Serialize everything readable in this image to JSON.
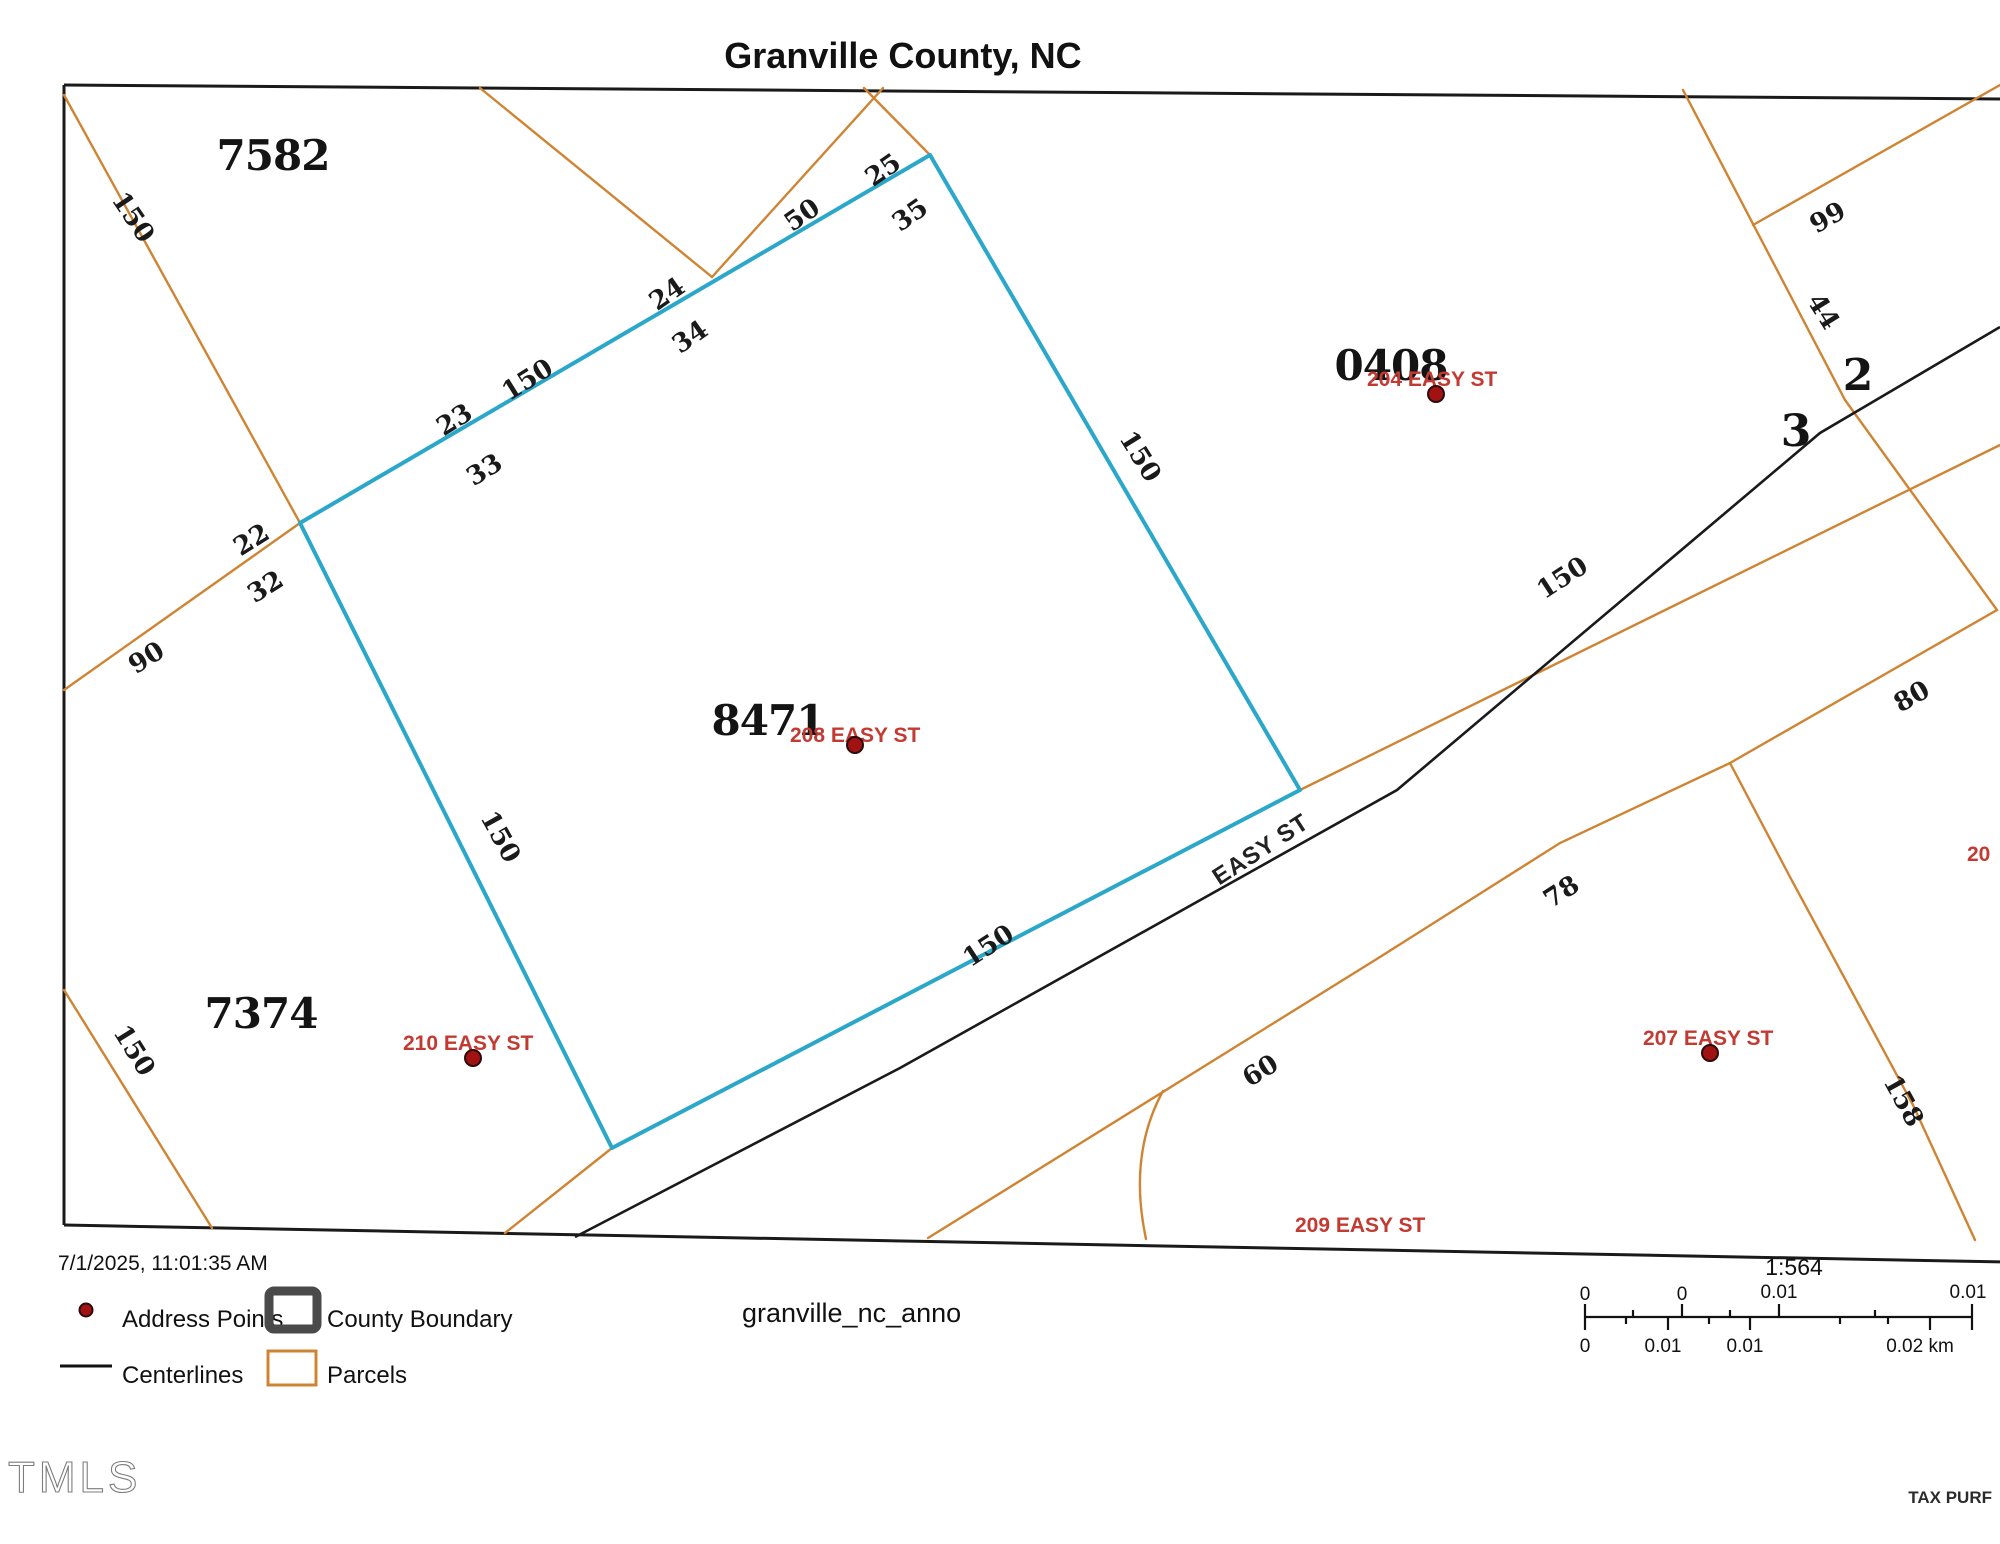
{
  "title": "Granville County, NC",
  "colors": {
    "parcel_line": "#cf8434",
    "highlight_parcel": "#2aa7c9",
    "centerline": "#1a1a1a",
    "address_text": "#c23a32",
    "address_dot": "#a11212"
  },
  "map": {
    "parcel_ids": {
      "p7582": "7582",
      "p0408": "0408",
      "p8471": "8471",
      "p7374": "7374",
      "n2": "2",
      "n3": "3"
    },
    "dimensions": {
      "d150_o1": "150",
      "d25": "25",
      "d50": "50",
      "d35": "35",
      "d24": "24",
      "d34": "34",
      "d150_nw": "150",
      "d23": "23",
      "d33": "33",
      "d22": "22",
      "d32": "32",
      "d90": "90",
      "d99": "99",
      "d44": "44",
      "d150_ne": "150",
      "d150_road": "150",
      "d80": "80",
      "d150_sw": "150",
      "d150_se": "150",
      "d78": "78",
      "d150_bl": "150",
      "d60": "60",
      "d158": "158"
    },
    "street": "EASY ST",
    "addresses": {
      "a204": "204 EASY ST",
      "a208": "208 EASY ST",
      "a210": "210 EASY ST",
      "a207": "207 EASY ST",
      "a209": "209 EASY ST",
      "a20": "20"
    }
  },
  "legend": {
    "timestamp": "7/1/2025, 11:01:35 AM",
    "items": {
      "address_points": "Address Points",
      "county_boundary": "County Boundary",
      "centerlines": "Centerlines",
      "parcels": "Parcels"
    },
    "layer_name": "granville_nc_anno"
  },
  "scalebar": {
    "ratio": "1:564",
    "top_labels": [
      "0",
      "0",
      "0.01",
      "0.01"
    ],
    "bottom_labels": [
      "0",
      "0.01",
      "0.01",
      "0.02 km"
    ]
  },
  "footer": {
    "logo": "TMLS",
    "note": "TAX PURF"
  }
}
